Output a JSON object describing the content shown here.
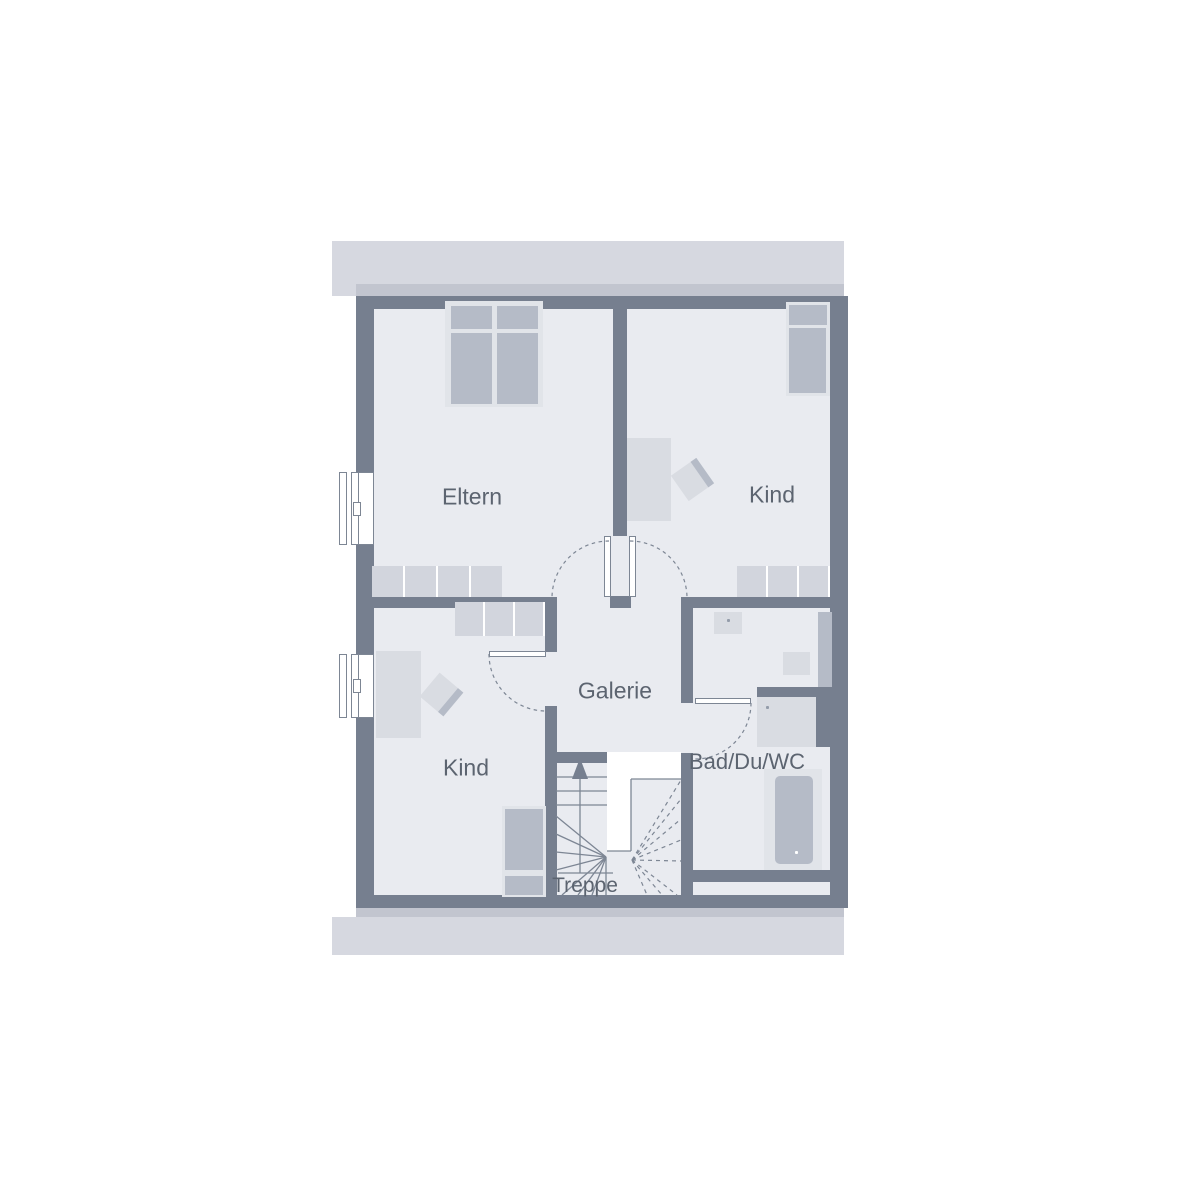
{
  "floorplan": {
    "rooms": {
      "eltern": {
        "label": "Eltern"
      },
      "kind_top": {
        "label": "Kind"
      },
      "kind_bottom": {
        "label": "Kind"
      },
      "galerie": {
        "label": "Galerie"
      },
      "treppe": {
        "label": "Treppe"
      },
      "bad": {
        "label": "Bad/Du/WC"
      }
    },
    "colors": {
      "wall": "#767f8f",
      "floor": "#e9ebf0",
      "band_light": "#d6d8e0",
      "band_medium": "#c2c5cf",
      "furn_light": "#d9dce2",
      "furn_lighter": "#e1e4e9",
      "furn_medium": "#b5bbc7",
      "dresser": "#d2d5dd",
      "line": "#7d8694",
      "text": "#5c6470",
      "dot": "#949caa"
    }
  }
}
